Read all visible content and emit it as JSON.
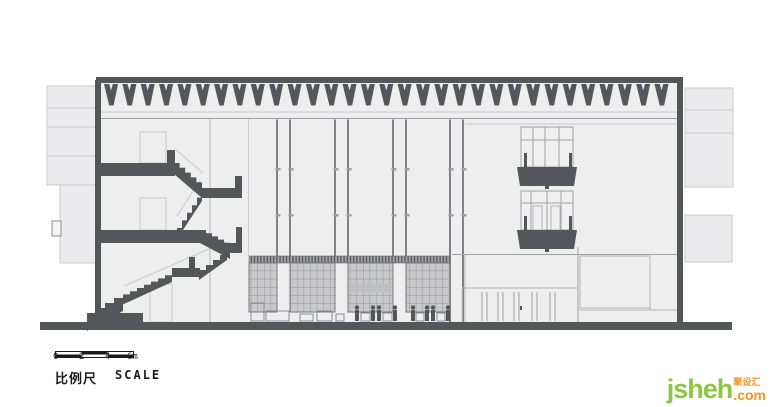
{
  "title": "architectural building cross-section drawing",
  "drawing": {
    "type": "building-section",
    "roof_baffle_count": 31,
    "column_pairs": [
      [
        277,
        290
      ],
      [
        335,
        348
      ],
      [
        393,
        406
      ],
      [
        450,
        463
      ]
    ],
    "colors": {
      "cut_dark": "#54565a",
      "line_strong": "#9fa0a2",
      "line_mid": "#b4b5b7",
      "line_soft": "#cacbcd",
      "building_fill": "#eeeeef",
      "mass_fill": "#ebebed",
      "grid_fill": "#c9c9cb",
      "grid_line": "#94959b",
      "hatch_bg": "#a6a6a9",
      "hatch_line": "#5a5b5e"
    }
  },
  "scale_bar": {
    "ticks": [
      "0",
      "2",
      "4",
      "6m"
    ],
    "label_cn": "比例尺",
    "label_en": "SCALE",
    "text_color": "#1c1c1c"
  },
  "watermark": {
    "name": "jsheh",
    "cn_tag": "聚设汇",
    "tld": ".com",
    "green": "#8dc63f",
    "orange": "#f6921e"
  }
}
